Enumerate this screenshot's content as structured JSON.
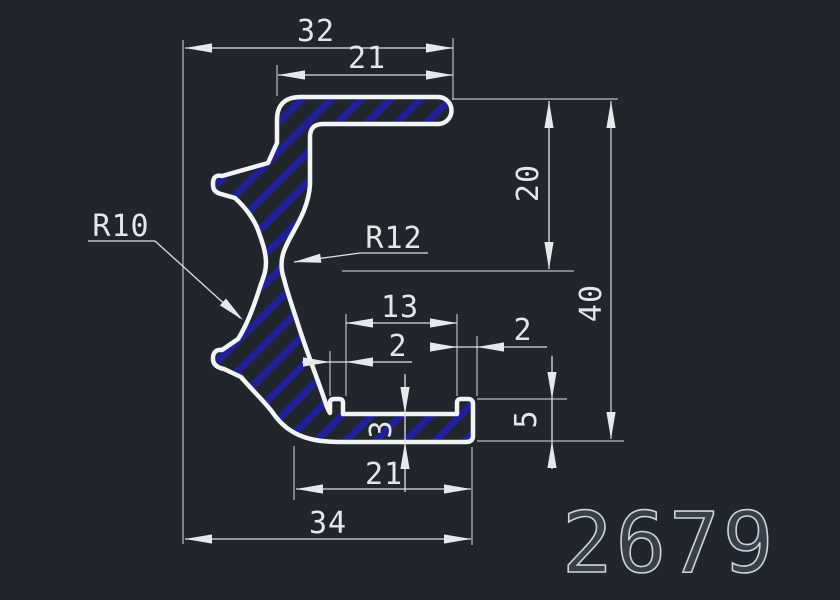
{
  "part_number": "2679",
  "colors": {
    "background": "#21262c",
    "profile_line": "#f3f4f5",
    "hatch_blue": "#20209a",
    "dim_line": "#dde1e4",
    "ext_line": "#b9bec4",
    "dim_text": "#e3e7ea"
  },
  "dims": {
    "top_overall_width": "32",
    "top_flange_width": "21",
    "upper_height": "20",
    "overall_height": "40",
    "left_radius": "R10",
    "waist_radius": "R12",
    "channel_width": "13",
    "left_lip_thickness": "2",
    "right_lip_thickness": "2",
    "lip_height": "5",
    "base_thickness": "3",
    "base_inner_width": "21",
    "base_overall_width": "34"
  }
}
